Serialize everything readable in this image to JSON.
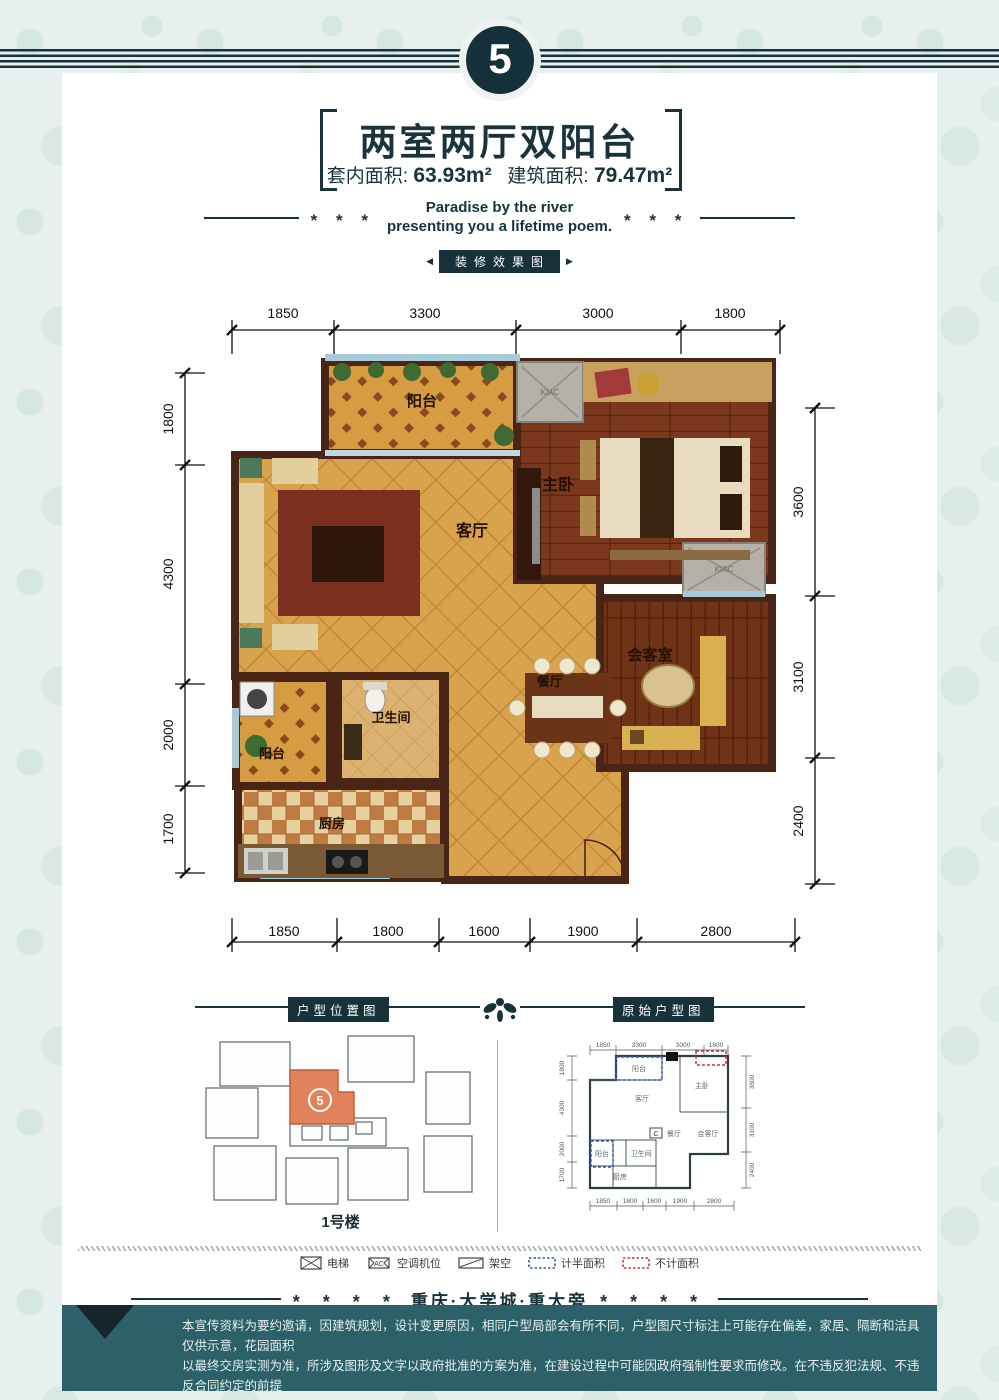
{
  "colors": {
    "ink": "#17323b",
    "band_teal": "#2c6169",
    "unit_orange": "#e2825c",
    "wall_brown": "#4a2414",
    "tile_tan": "#d9a24c"
  },
  "header": {
    "badge": "5",
    "title": "两室两厅双阳台",
    "area_inner_label": "套内面积:",
    "area_inner_value": "63.93m²",
    "area_build_label": "建筑面积:",
    "area_build_value": "79.47m²",
    "tagline_line1": "Paradise by the river",
    "tagline_line2": "presenting you a lifetime poem.",
    "stars": "* * *",
    "section_label": "装修效果图",
    "arrow_left": "◀",
    "arrow_right": "▶"
  },
  "floorplan": {
    "dims_top": [
      "1850",
      "3300",
      "3000",
      "1800"
    ],
    "dims_left": [
      "1800",
      "4300",
      "2000",
      "1700"
    ],
    "dims_right": [
      "3600",
      "3100",
      "2400"
    ],
    "dims_bottom": [
      "1850",
      "1800",
      "1600",
      "1900",
      "2800"
    ],
    "rooms": {
      "balcony_top": "阳台",
      "living": "客厅",
      "master": "主卧",
      "reception": "会客室",
      "dining": "餐厅",
      "bath": "卫生间",
      "balcony_side": "阳台",
      "kitchen": "厨房"
    },
    "ac_label": "K/AC"
  },
  "location_map": {
    "header": "户型位置图",
    "unit_number": "5",
    "building_label": "1号楼"
  },
  "original_plan": {
    "header": "原始户型图",
    "dims_top": [
      "1850",
      "3300",
      "3000",
      "1800"
    ],
    "dims_left": [
      "1800",
      "4300",
      "2000",
      "1700"
    ],
    "dims_right": [
      "3600",
      "3100",
      "2400"
    ],
    "dims_bottom": [
      "1850",
      "1800",
      "1600",
      "1900",
      "2800"
    ],
    "rooms": {
      "balcony_top": "阳台",
      "living": "客厅",
      "master": "主卧",
      "reception": "会客厅",
      "dining": "餐厅",
      "bath": "卫生间",
      "balcony_side": "阳台",
      "kitchen": "厨房"
    },
    "ac_label": "C"
  },
  "legend": {
    "items": [
      {
        "label": "电梯"
      },
      {
        "label": "空调机位",
        "icon_text": "AC"
      },
      {
        "label": "架空"
      },
      {
        "label": "计半面积"
      },
      {
        "label": "不计面积"
      }
    ]
  },
  "footer": {
    "stars": "* * * *",
    "location_line": "重庆·大学城·重大旁",
    "disclaimer_line1": "本宣传资料为要约邀请，因建筑规划，设计变更原因，相同户型局部会有所不同，户型图尺寸标注上可能存在偏差，家居、隔断和洁具仅供示意，花园面积",
    "disclaimer_line2": "以最终交房实测为准，所涉及图形及文字以政府批准的方案为准，在建设过程中可能因政府强制性要求而修改。在不违反犯法规、不违反合同约定的前提",
    "disclaimer_line3": "下，本公司亦有权做出细部调整，开发商不再另行通知，敬请关注相关最新宣传资料，买卖双方权利以双方签订的商品房买卖合同约定为准。"
  }
}
